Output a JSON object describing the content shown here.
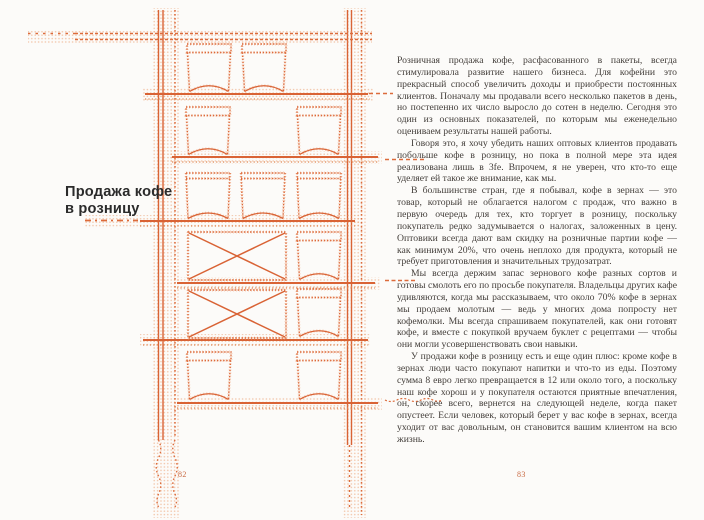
{
  "book": {
    "left_page": {
      "heading_line1": "Продажа кофе",
      "heading_line2": "в розницу",
      "page_number": "82",
      "illustration": {
        "name": "halftone-coffee-bags-on-shelves",
        "description": "dotted orange shelving rack with coffee bags, tins and crossed boxes",
        "accent_color": "#DC6838"
      }
    },
    "right_page": {
      "page_number": "83",
      "paragraphs": [
        "Розничная продажа кофе, расфасованного в пакеты, всегда стимулировала развитие нашего бизнеса. Для кофейни это прекрасный способ увеличить доходы и приобрести постоянных клиентов. Поначалу мы продавали всего несколько пакетов в день, но постепенно их число выросло до сотен в неделю. Сегодня это один из основных показателей, по которым мы еженедельно оцениваем результаты нашей работы.",
        "Говоря это, я хочу убедить наших оптовых клиентов продавать побольше кофе в розницу, но пока в полной мере эта идея реализована лишь в 3fe. Впрочем, я не уверен, что кто-то еще уделяет ей такое же внимание, как мы.",
        "В большинстве стран, где я побывал, кофе в зернах — это товар, который не облагается налогом с продаж, что важно в первую очередь для тех, кто торгует в розницу, поскольку покупатель редко задумывается о налогах, заложенных в цену. Оптовики всегда дают вам скидку на розничные партии кофе — как минимум 20%, что очень неплохо для продукта, который не требует приготовления и значительных трудозатрат.",
        "Мы всегда держим запас зернового кофе разных сортов и готовы смолоть его по просьбе покупателя. Владельцы других кафе удивляются, когда мы рассказываем, что около 70% кофе в зернах мы продаем молотым — ведь у многих дома попросту нет кофемолки. Мы всегда спрашиваем покупателей, как они готовят кофе, и вместе с покупкой вручаем буклет с рецептами — чтобы они могли усовершенствовать свои навыки.",
        "У продажи кофе в розницу есть и еще один плюс: кроме кофе в зернах люди часто покупают напитки и что-то из еды. Поэтому сумма 8 евро легко превращается в 12 или около того, а поскольку наш кофе хорош и у покупателя остаются приятные впечатления, он, скорее всего, вернется на следующей неделе, когда пакет опустеет. Если человек, который берет у вас кофе в зернах, всегда уходит от вас довольным, он становится вашим клиентом на всю жизнь."
      ]
    },
    "colors": {
      "accent_orange": "#DC6838",
      "solid_orange": "#D96335",
      "heading_text": "#2B2B2B",
      "body_text": "#433E3A",
      "page_number": "#C96A43",
      "page_background": "#FCFBF9"
    }
  }
}
